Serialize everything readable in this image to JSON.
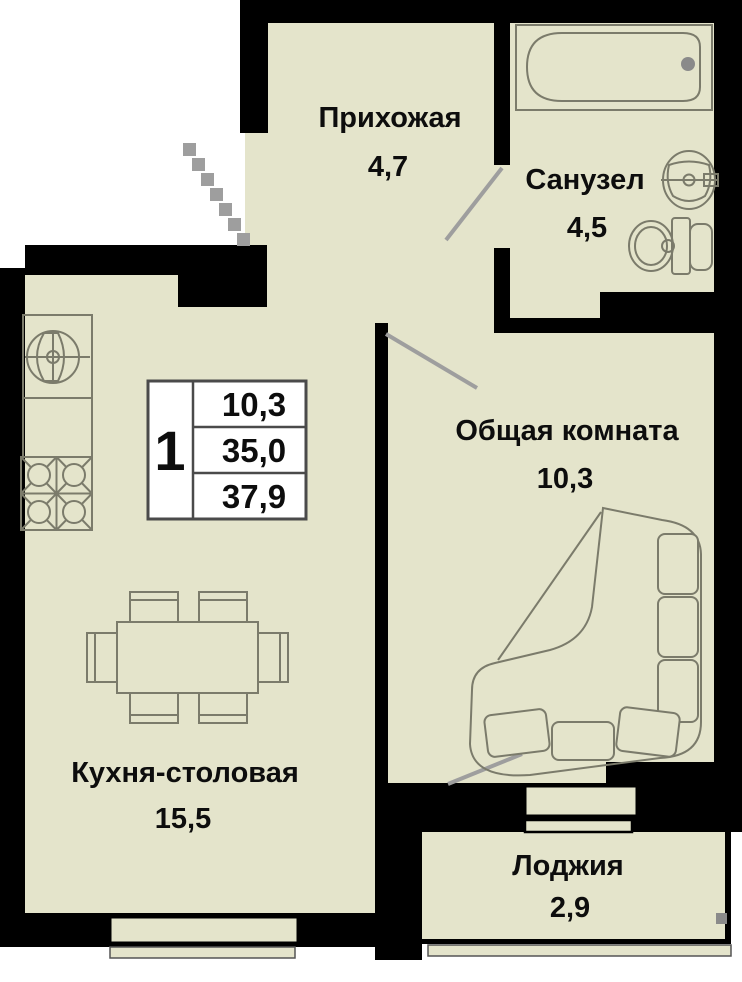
{
  "plan_title": "1-комнатная квартира — план",
  "colors": {
    "background": "#ffffff",
    "floor": "#e4e4cb",
    "walls": "#000000",
    "furniture_outline": "#7b7b6b",
    "door_lines": "#9e9e9e",
    "legend_border": "#4a4a4a",
    "text": "#0d0d0d"
  },
  "rooms": {
    "hallway": {
      "name": "Прихожая",
      "area": "4,7"
    },
    "bathroom": {
      "name": "Санузел",
      "area": "4,5"
    },
    "living": {
      "name": "Общая комната",
      "area": "10,3"
    },
    "kitchen": {
      "name": "Кухня-столовая",
      "area": "15,5"
    },
    "loggia": {
      "name": "Лоджия",
      "area": "2,9"
    }
  },
  "legend": {
    "apartment_number": "1",
    "rows": [
      "10,3",
      "35,0",
      "37,9"
    ]
  },
  "fixtures": [
    "bathtub-icon",
    "wash-basin-icon",
    "toilet-icon",
    "kitchen-sink-icon",
    "stove-icon",
    "dining-table-icon",
    "chair-icon",
    "sofa-icon",
    "entrance-steps-icon",
    "window-icon",
    "door-swing-icon"
  ]
}
